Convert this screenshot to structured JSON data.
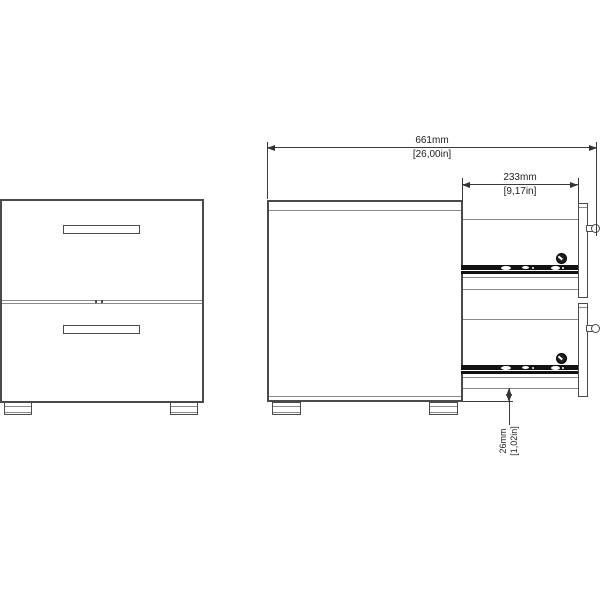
{
  "diagram": {
    "dimensions": {
      "total_depth": {
        "metric": "661mm",
        "imperial": "[26,00in]"
      },
      "drawer_depth": {
        "metric": "233mm",
        "imperial": "[9,17in]"
      },
      "bottom_clearance": {
        "metric": "26mm",
        "imperial": "[1,02in]"
      }
    },
    "colors": {
      "outline": "#4a4a4a",
      "inner_line": "#8a8a8a",
      "slide_rail": "#121212",
      "dimension_line": "#333333",
      "background": "#ffffff"
    }
  }
}
